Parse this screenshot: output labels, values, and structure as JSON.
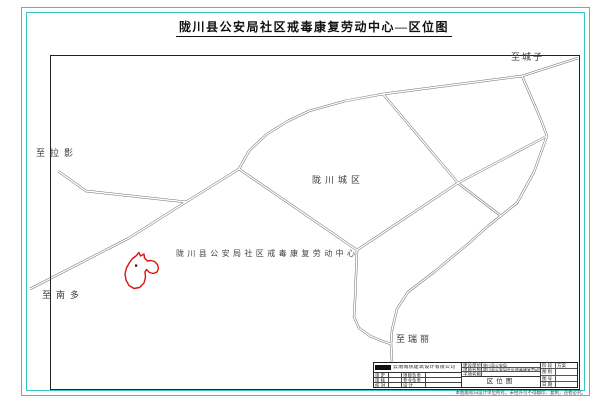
{
  "page": {
    "title": "陇川县公安局社区戒毒康复劳动中心—区位图"
  },
  "map": {
    "labels": {
      "to_chengzi": "至城子",
      "to_laying": "至拉影",
      "to_nanduo": "至南多",
      "to_ruili": "至瑞丽",
      "city_area": "陇川城区",
      "site": "陇川县公安局社区戒毒康复劳动中心"
    },
    "colors": {
      "sheet_border": "#35c6c6",
      "road_line": "#6b6b6b",
      "site_boundary": "#dd1111"
    }
  },
  "title_block": {
    "company": "云南城热建筑设计有限公司",
    "left_rows": [
      {
        "label": "审 定",
        "label2": "项目负责"
      },
      {
        "label": "审 核",
        "label2": "专业负责"
      },
      {
        "label": "校 对",
        "label2": "设 计"
      }
    ],
    "fields": [
      {
        "label": "建设单位",
        "value": "陇川县公安局"
      },
      {
        "label": "项目名称",
        "value": "陇川县公安局社区戒毒康复劳动中心"
      },
      {
        "label": "子项名称",
        "value": ""
      }
    ],
    "drawing_title": "区位图",
    "right_rows": [
      {
        "label": "阶 段",
        "value": "方案"
      },
      {
        "label": "图 别",
        "value": ""
      },
      {
        "label": "图 号",
        "value": ""
      },
      {
        "label": "日 期",
        "value": ""
      }
    ],
    "note": "本图版权归设计单位所有，未经许可不得翻印、复制，违者必究。"
  }
}
